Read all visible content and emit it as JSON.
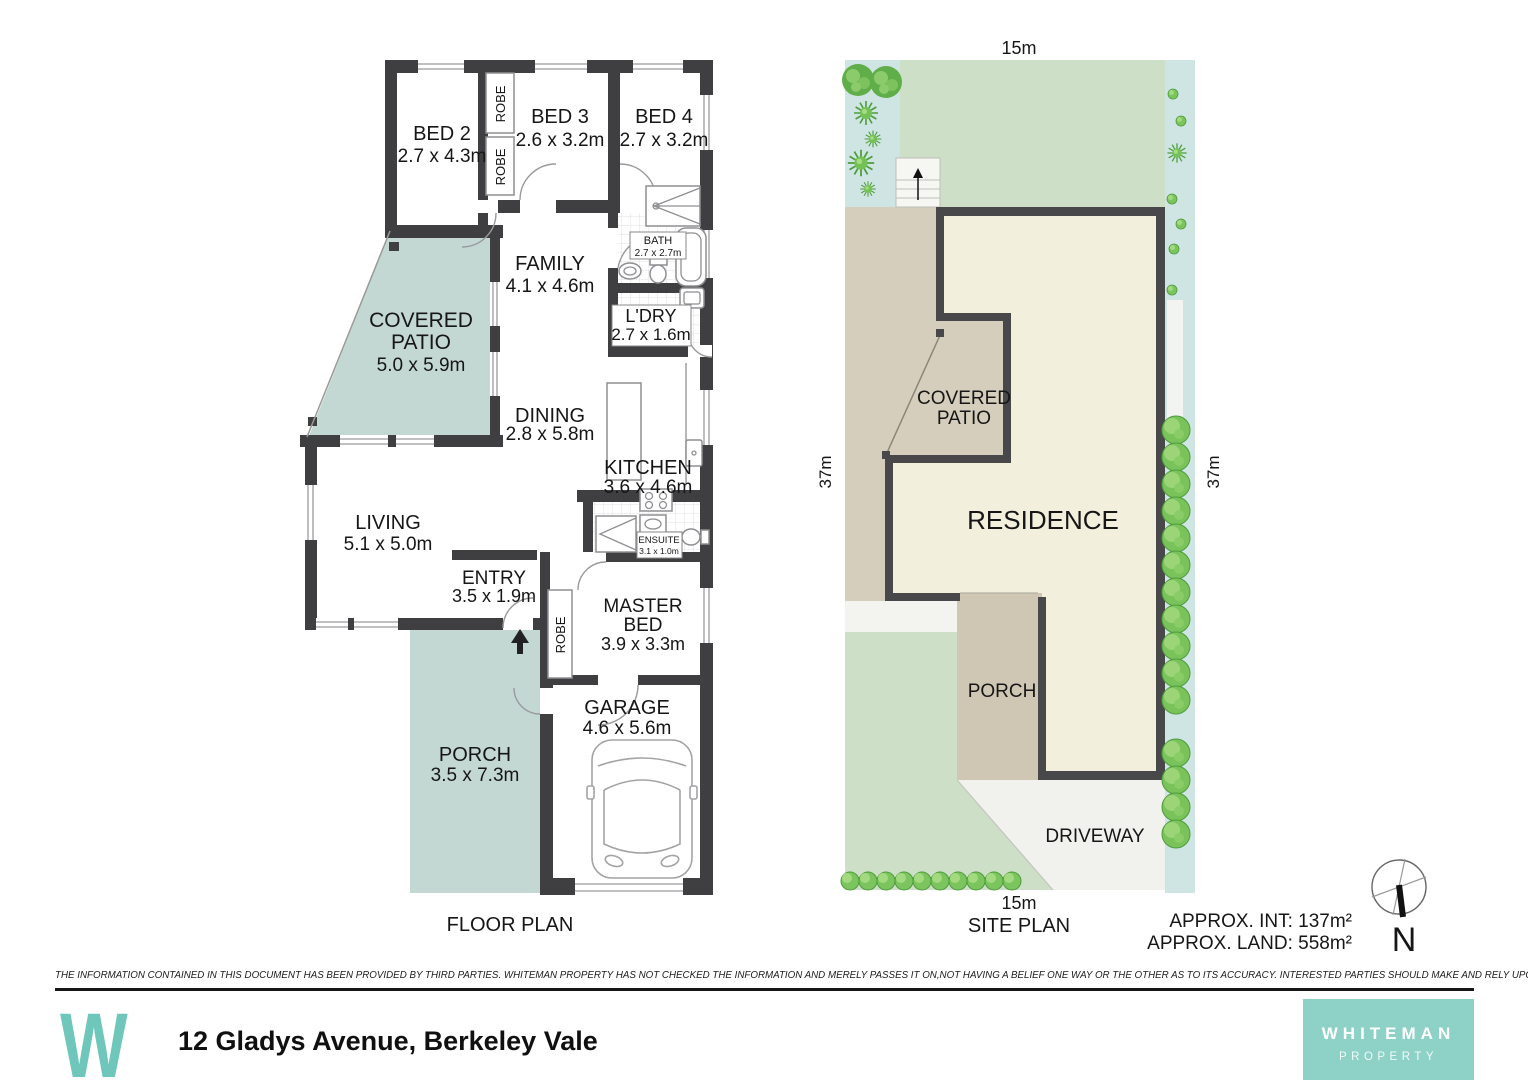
{
  "page": {
    "floor_plan_title": "FLOOR PLAN",
    "site_plan_title": "SITE PLAN"
  },
  "floor_plan": {
    "rooms": {
      "bed2": {
        "name": "BED 2",
        "dims": "2.7 x 4.3m"
      },
      "bed3": {
        "name": "BED 3",
        "dims": "2.6 x 3.2m"
      },
      "bed4": {
        "name": "BED 4",
        "dims": "2.7 x 3.2m"
      },
      "family": {
        "name": "FAMILY",
        "dims": "4.1 x 4.6m"
      },
      "bath": {
        "name": "BATH",
        "dims": "2.7 x 2.7m"
      },
      "ldry": {
        "name": "L'DRY",
        "dims": "2.7 x 1.6m"
      },
      "covered_patio": {
        "line1": "COVERED",
        "line2": "PATIO",
        "dims": "5.0 x 5.9m"
      },
      "dining": {
        "name": "DINING",
        "dims": "2.8 x 5.8m"
      },
      "kitchen": {
        "name": "KITCHEN",
        "dims": "3.6 x 4.6m"
      },
      "living": {
        "name": "LIVING",
        "dims": "5.1 x 5.0m"
      },
      "entry": {
        "name": "ENTRY",
        "dims": "3.5 x 1.9m"
      },
      "ensuite": {
        "name": "ENSUITE",
        "dims": "3.1 x 1.0m"
      },
      "master_bed": {
        "line1": "MASTER",
        "line2": "BED",
        "dims": "3.9 x 3.3m"
      },
      "garage": {
        "name": "GARAGE",
        "dims": "4.6 x 5.6m"
      },
      "porch": {
        "name": "PORCH",
        "dims": "3.5 x 7.3m"
      },
      "robe_label": "ROBE"
    }
  },
  "site_plan": {
    "labels": {
      "residence": "RESIDENCE",
      "covered_patio_line1": "COVERED",
      "covered_patio_line2": "PATIO",
      "porch": "PORCH",
      "driveway": "DRIVEWAY"
    },
    "dims": {
      "top": "15m",
      "bottom": "15m",
      "left": "37m",
      "right": "37m"
    },
    "areas": {
      "interior": "APPROX. INT: 137m²",
      "land": "APPROX. LAND: 558m²"
    },
    "compass_label": "N"
  },
  "footer": {
    "disclaimer": "THE INFORMATION CONTAINED IN THIS DOCUMENT HAS BEEN PROVIDED BY THIRD PARTIES. WHITEMAN PROPERTY HAS NOT CHECKED THE INFORMATION AND MERELY PASSES IT ON,NOT HAVING A BELIEF ONE WAY OR THE OTHER AS TO ITS ACCURACY. INTERESTED PARTIES SHOULD MAKE AND RELY UPON THEIR OWN ENQUIRIES.",
    "address": "12 Gladys Avenue, Berkeley Vale",
    "brand": {
      "logo_letter": "W",
      "name": "WHITEMAN",
      "subtitle": "PROPERTY"
    }
  },
  "colors": {
    "wall": "#3f3f41",
    "patio_teal": "#c3d7d3",
    "lawn_green": "#cddfc6",
    "yard_tan": "#d5cebc",
    "residence_cream": "#f2f0dd",
    "border_blue": "#cfe5e4",
    "driveway_white": "#f1f1ee",
    "shrub_green": "#76c258",
    "brand_teal": "#8ed1c7",
    "logo_teal": "#6fc7bb"
  }
}
